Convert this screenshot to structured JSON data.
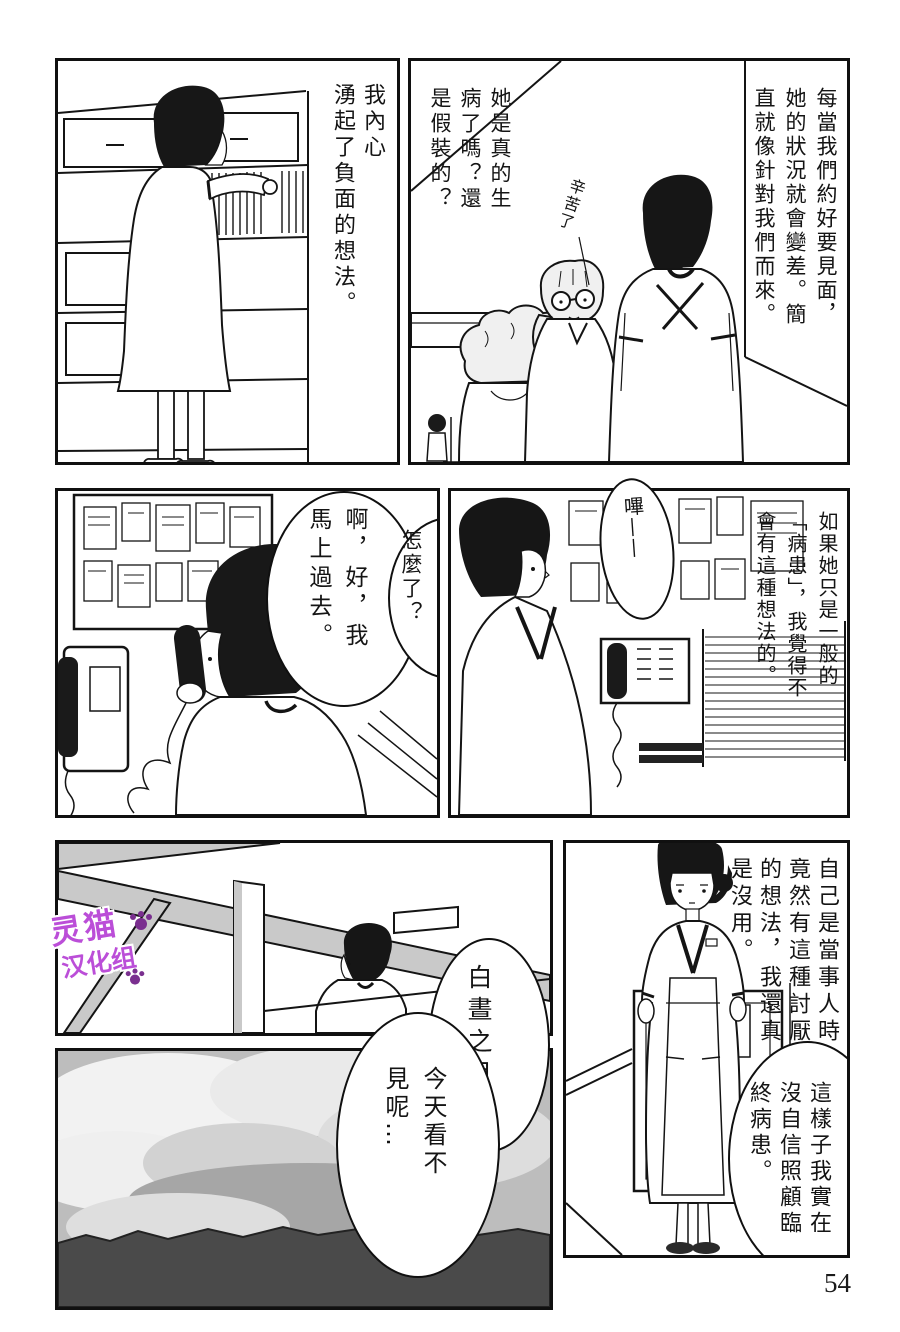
{
  "page_number": "54",
  "watermark": {
    "line1": "灵猫",
    "line2": "汉化组"
  },
  "colors": {
    "watermark": "#bb4ed8",
    "ink": "#141414",
    "screen_tone": "#c9c9c9"
  },
  "panels": {
    "top_left": {
      "thought": "我內心\n湧起了負面的想法。"
    },
    "top_right": {
      "narration": "每當我們約好要見面，\n她的狀況就會變差。簡\n直就像針對我們而來。",
      "thought": "她是真的生\n病了嗎？還\n是假裝的？",
      "handwritten_sfx": "辛苦了"
    },
    "mid_left": {
      "phone_voice": "怎麼了？",
      "reply": "啊，好，我\n馬上過去。"
    },
    "mid_right": {
      "beep_sfx": "嗶——",
      "narration": "如果她只是一般的\n「病患」，我覺得不\n會有這種想法的。"
    },
    "bottom_left": {
      "moon_bubble": "白晝之月…",
      "today_bubble": "今天看不\n見呢…"
    },
    "bottom_right": {
      "narration": "自己是當事人時\n竟然有這種討厭\n的想法，我還真\n是沒用。",
      "speech": "這樣子我實在\n沒自信照顧臨\n終病患。"
    }
  }
}
